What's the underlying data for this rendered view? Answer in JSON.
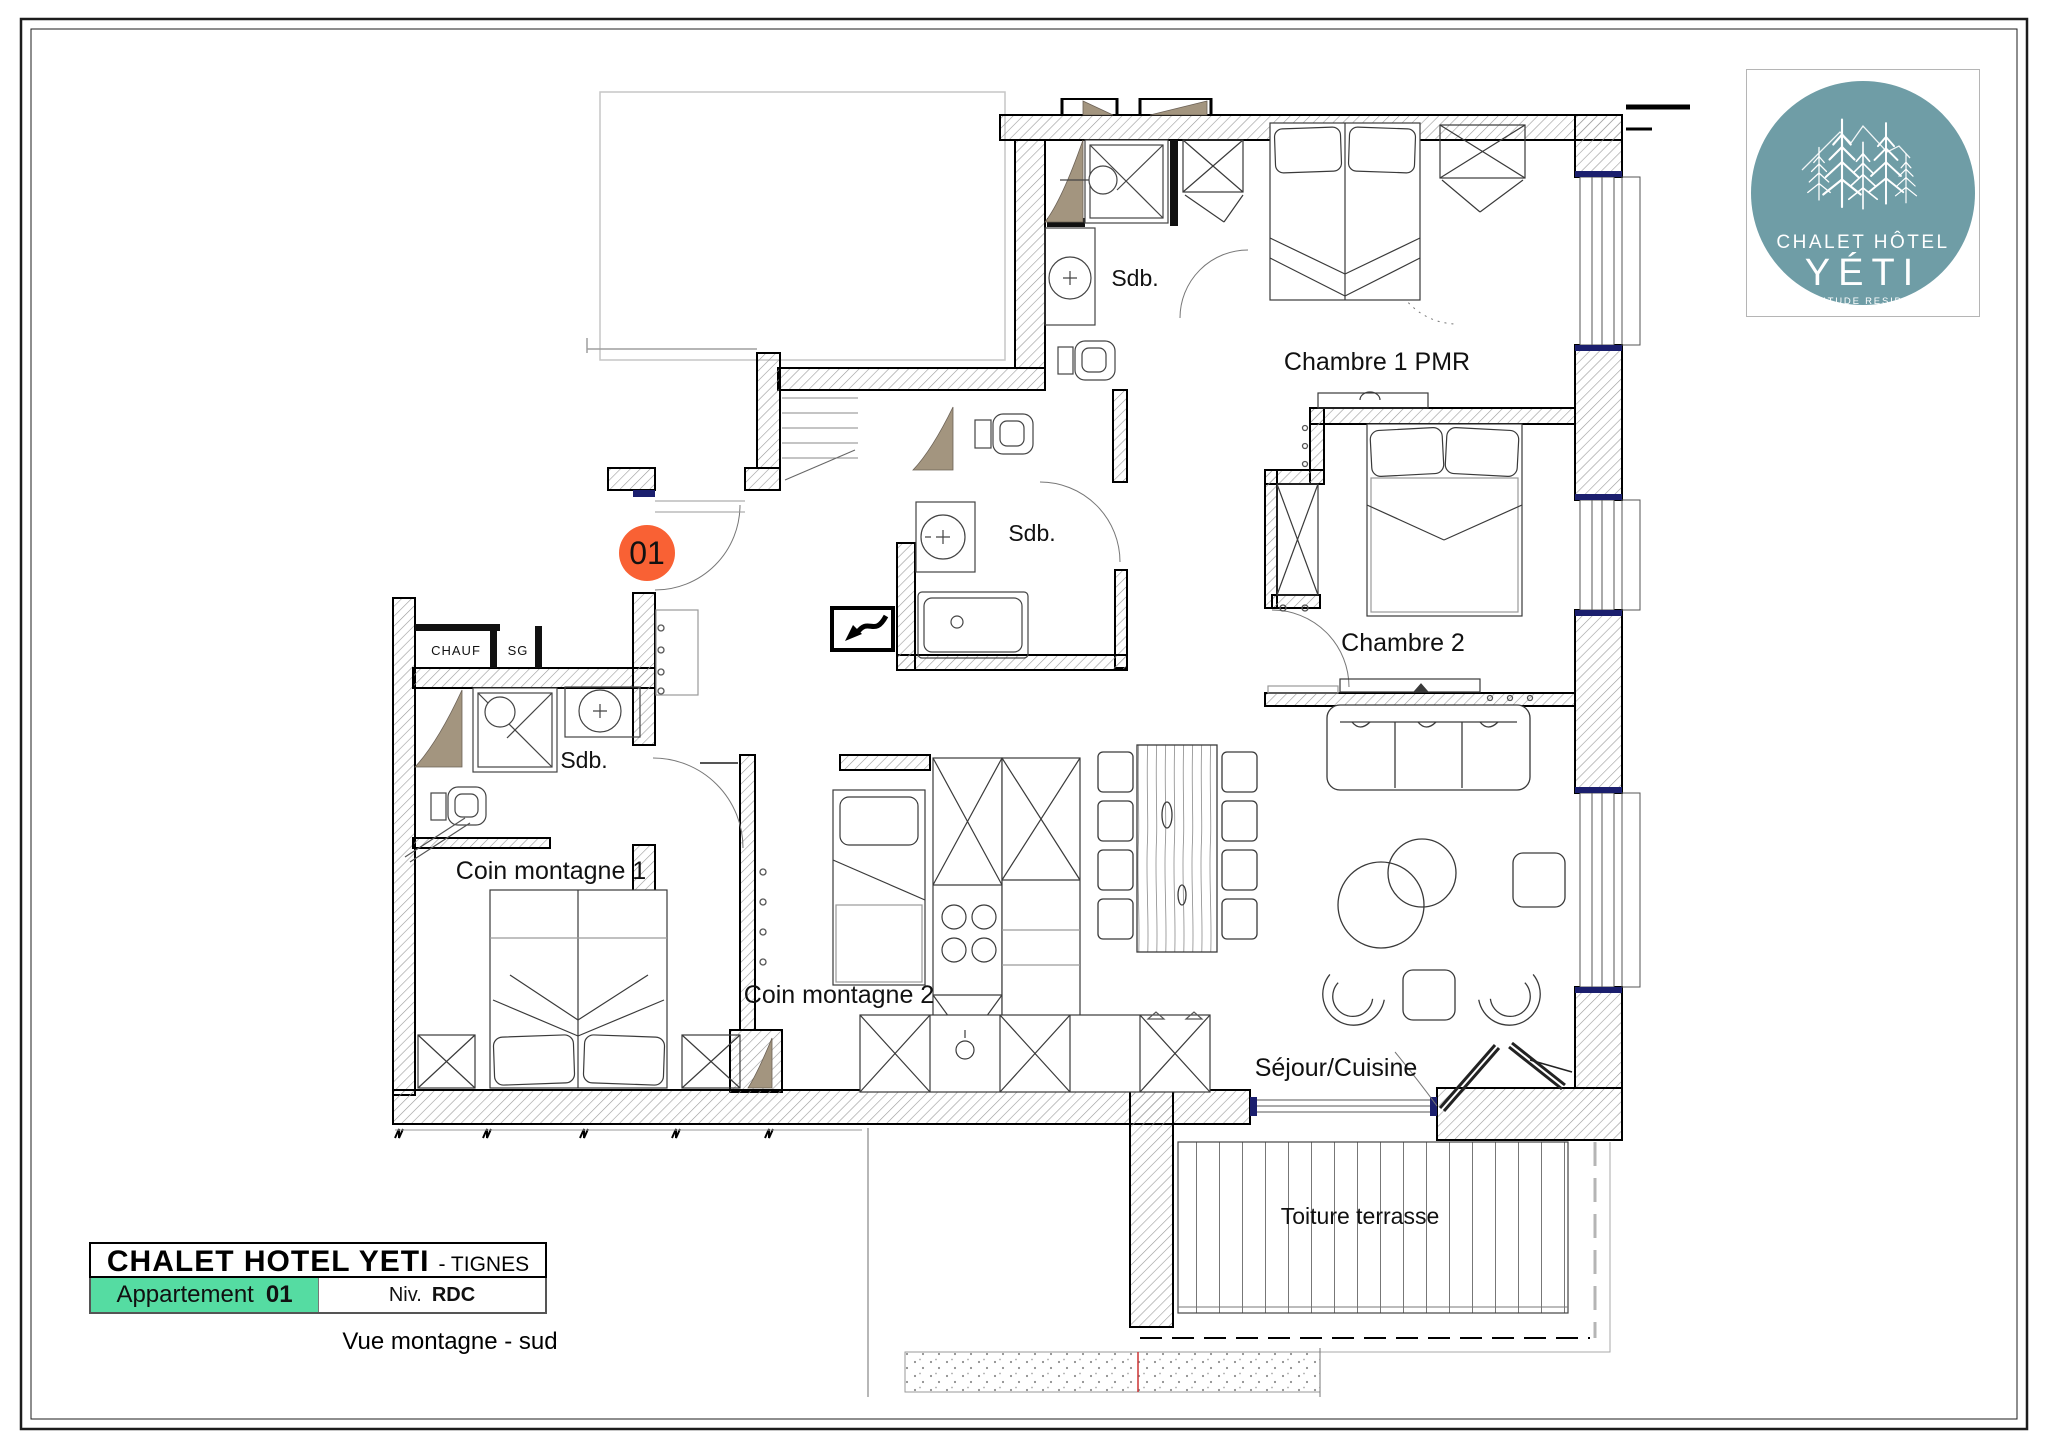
{
  "plan": {
    "unit_badge": "01",
    "rooms": {
      "sdb_top": "Sdb.",
      "chambre1": "Chambre 1 PMR",
      "sdb_mid": "Sdb.",
      "chambre2": "Chambre 2",
      "chauf": "CHAUF",
      "sg": "SG",
      "sdb_left": "Sdb.",
      "coin1": "Coin montagne 1",
      "coin2": "Coin montagne 2",
      "sejour": "Séjour/Cuisine",
      "terrasse": "Toiture terrasse"
    },
    "colors": {
      "badge_orange": "#f96134",
      "threshold_navy": "#1b1f6e",
      "taupe": "#a3957f",
      "hatch_gray": "#9a9a9a"
    }
  },
  "logo": {
    "line1": "CHALET HÔTEL",
    "line2": "YÉTI",
    "line3": "BY ALTITUDE RESIDENCES",
    "circle_color": "#6f9da6"
  },
  "title_block": {
    "project": "CHALET HOTEL YETI",
    "project_suffix": "- TIGNES",
    "apartment_label": "Appartement",
    "apartment_number": "01",
    "level_label": "Niv.",
    "level_value": "RDC",
    "view_caption": "Vue montagne - sud",
    "highlight_color": "#55dca2"
  }
}
